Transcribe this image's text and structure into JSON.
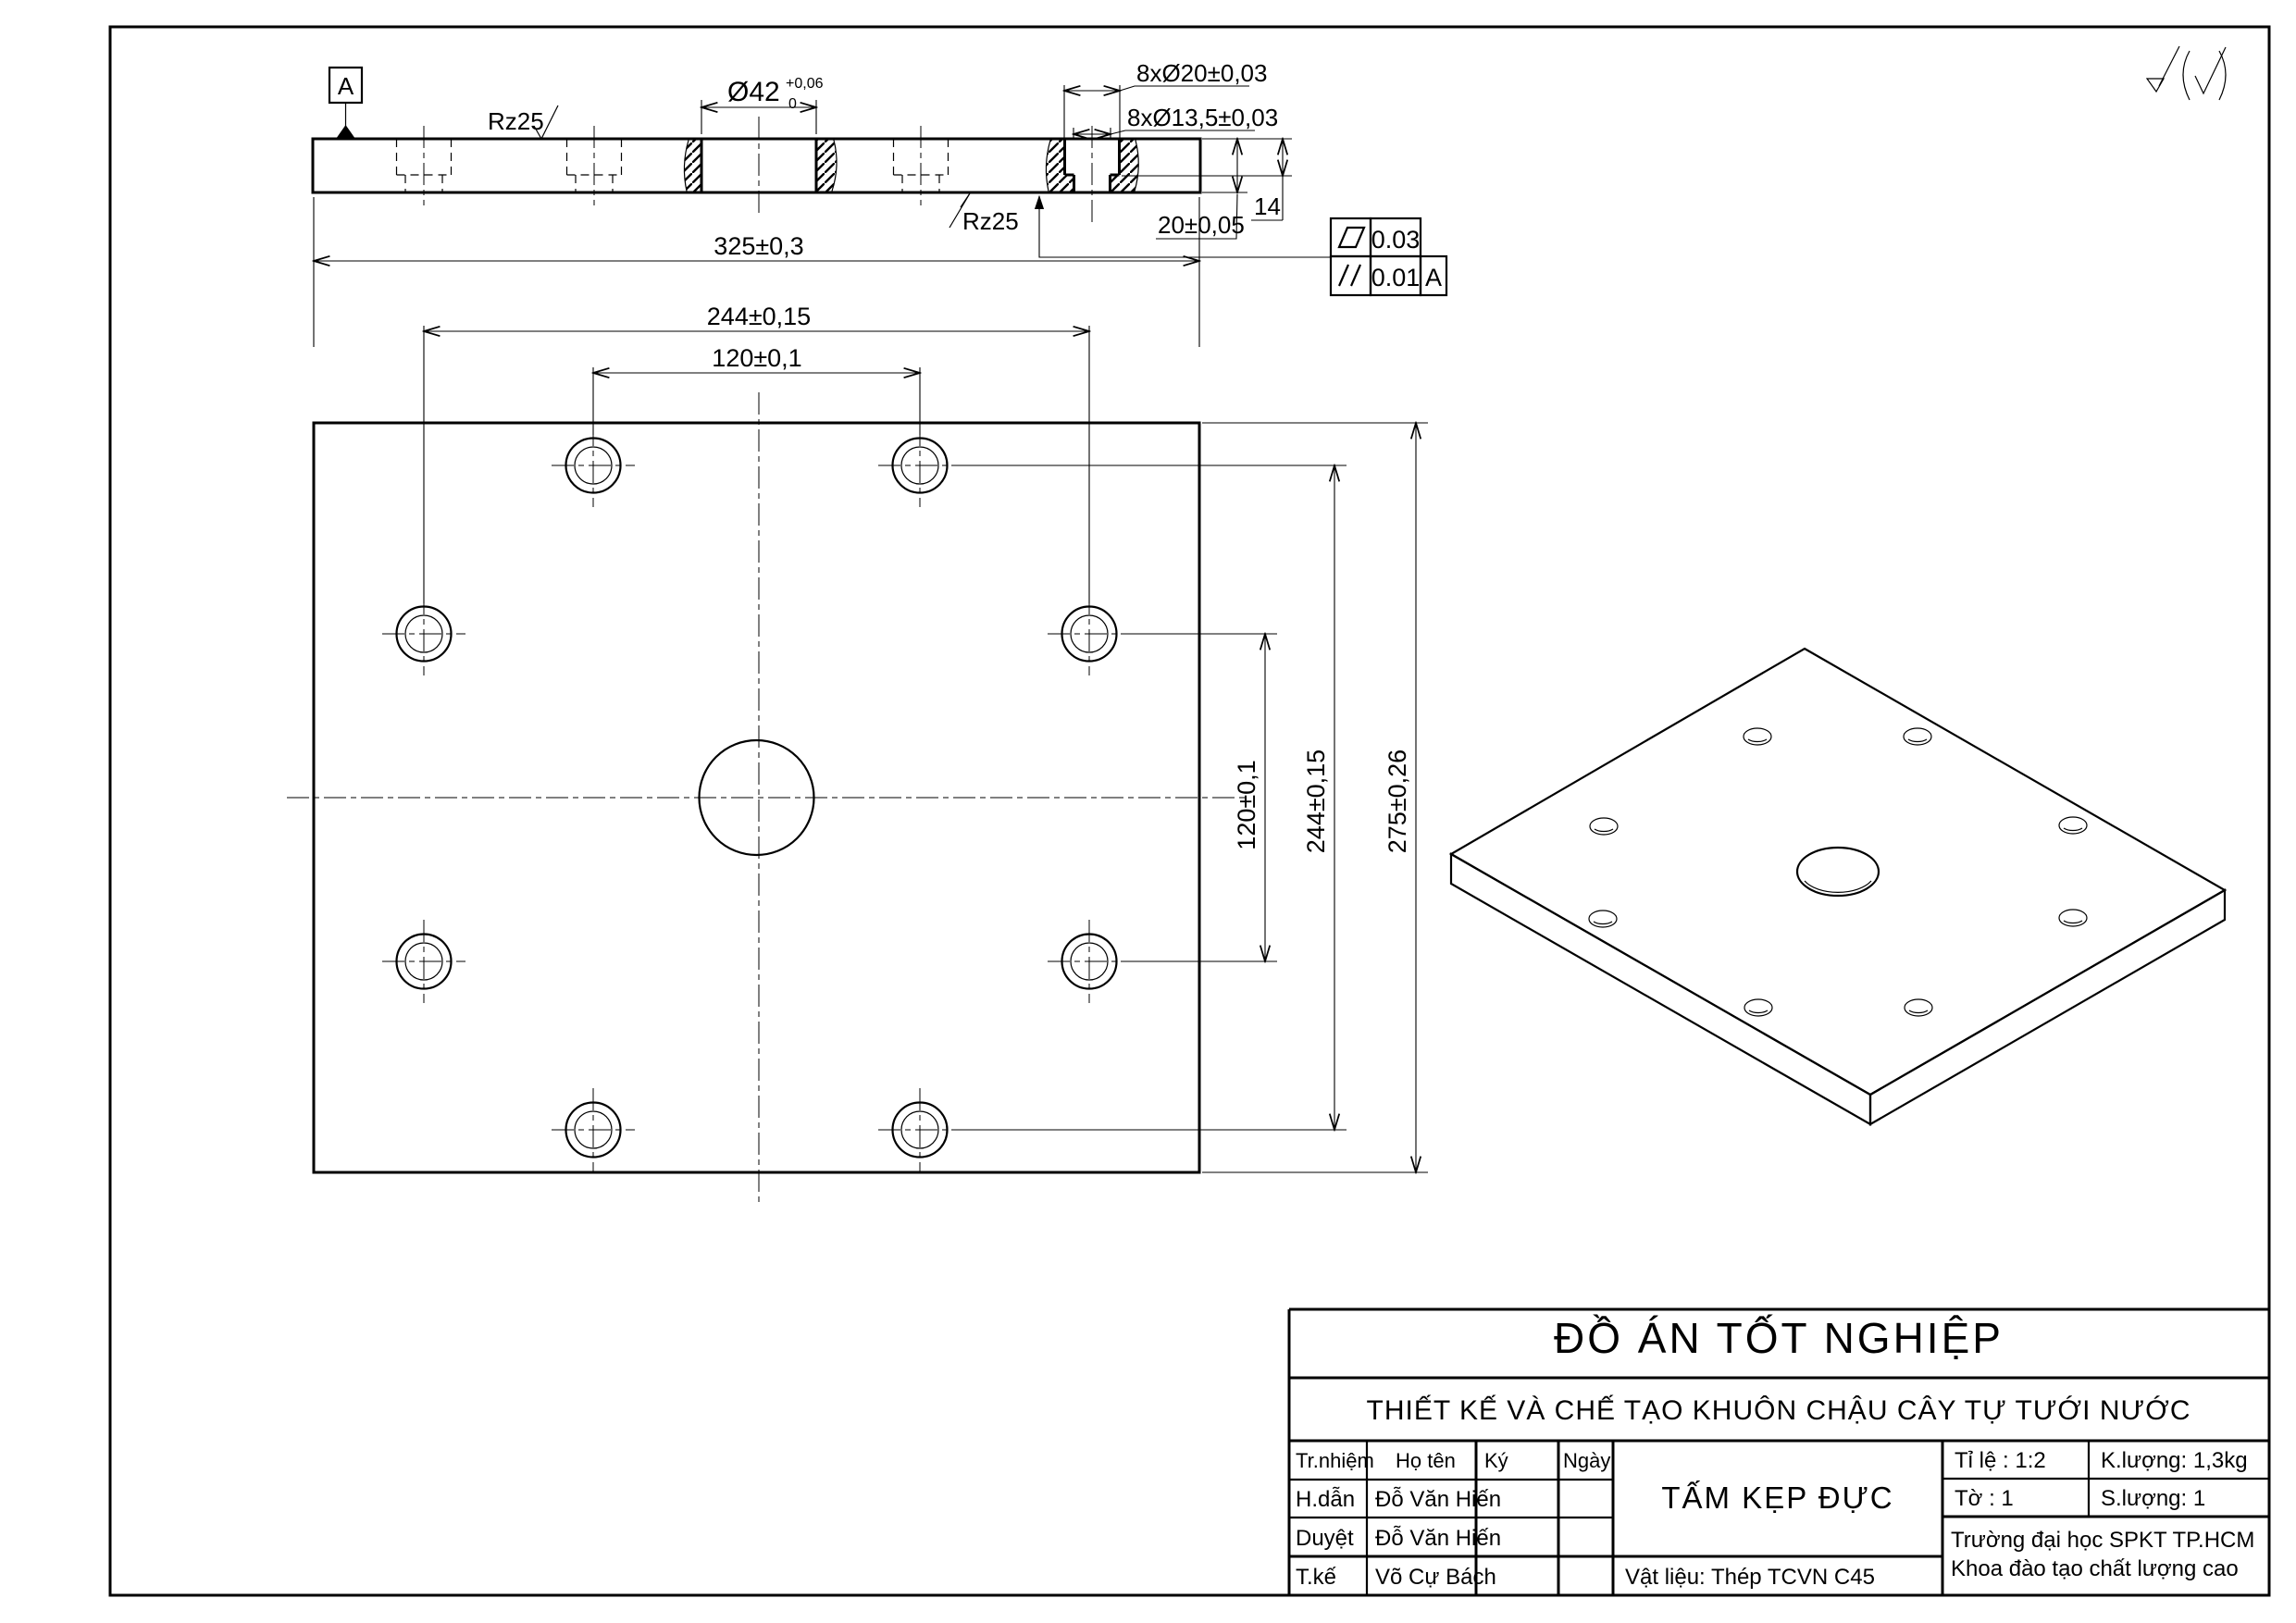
{
  "drawing": {
    "project_title": "ĐỒ ÁN TỐT NGHIỆP",
    "project_subtitle": "THIẾT KẾ VÀ CHẾ TẠO KHUÔN CHẬU CÂY TỰ TƯỚI NƯỚC",
    "part_name": "TẤM KẸP ĐỰC",
    "material_label": "Vật liệu: Thép TCVN C45",
    "surface_note": "√(√)"
  },
  "title_block": {
    "col_role": "Tr.nhiệm",
    "col_name": "Họ tên",
    "col_sign": "Ký",
    "col_date": "Ngày",
    "rows": [
      {
        "role": "H.dẫn",
        "name": "Đỗ Văn Hiến"
      },
      {
        "role": "Duyệt",
        "name": "Đỗ Văn Hiến"
      },
      {
        "role": "T.kế",
        "name": "Võ Cự Bách"
      }
    ],
    "scale_label": "Tỉ lệ : 1:2",
    "sheet_label": "Tờ : 1",
    "weight_label": "K.lượng:   1,3kg",
    "qty_label": "S.lượng: 1",
    "org_line1": "Trường đại học SPKT TP.HCM",
    "org_line2": "Khoa đào tạo chất lượng cao"
  },
  "dims": {
    "width": "325±0,3",
    "bolt_cols": "244±0,15",
    "hole_cols": "120±0,1",
    "hole_rows": "120±0,1",
    "bolt_rows": "244±0,15",
    "height": "275±0,26",
    "center_dia": "Ø42",
    "center_tol_up": "+0,06",
    "center_tol_dn": "0",
    "cbore": "8xØ20±0,03",
    "thru": "8xØ13,5±0,03",
    "thickness": "20±0,05",
    "depth": "14"
  },
  "surface": {
    "top": "Rz25",
    "bottom": "Rz25"
  },
  "gdt": {
    "datum": "A",
    "flatness": "0.03",
    "parallelism": "0.01",
    "parallelism_datum": "A"
  }
}
